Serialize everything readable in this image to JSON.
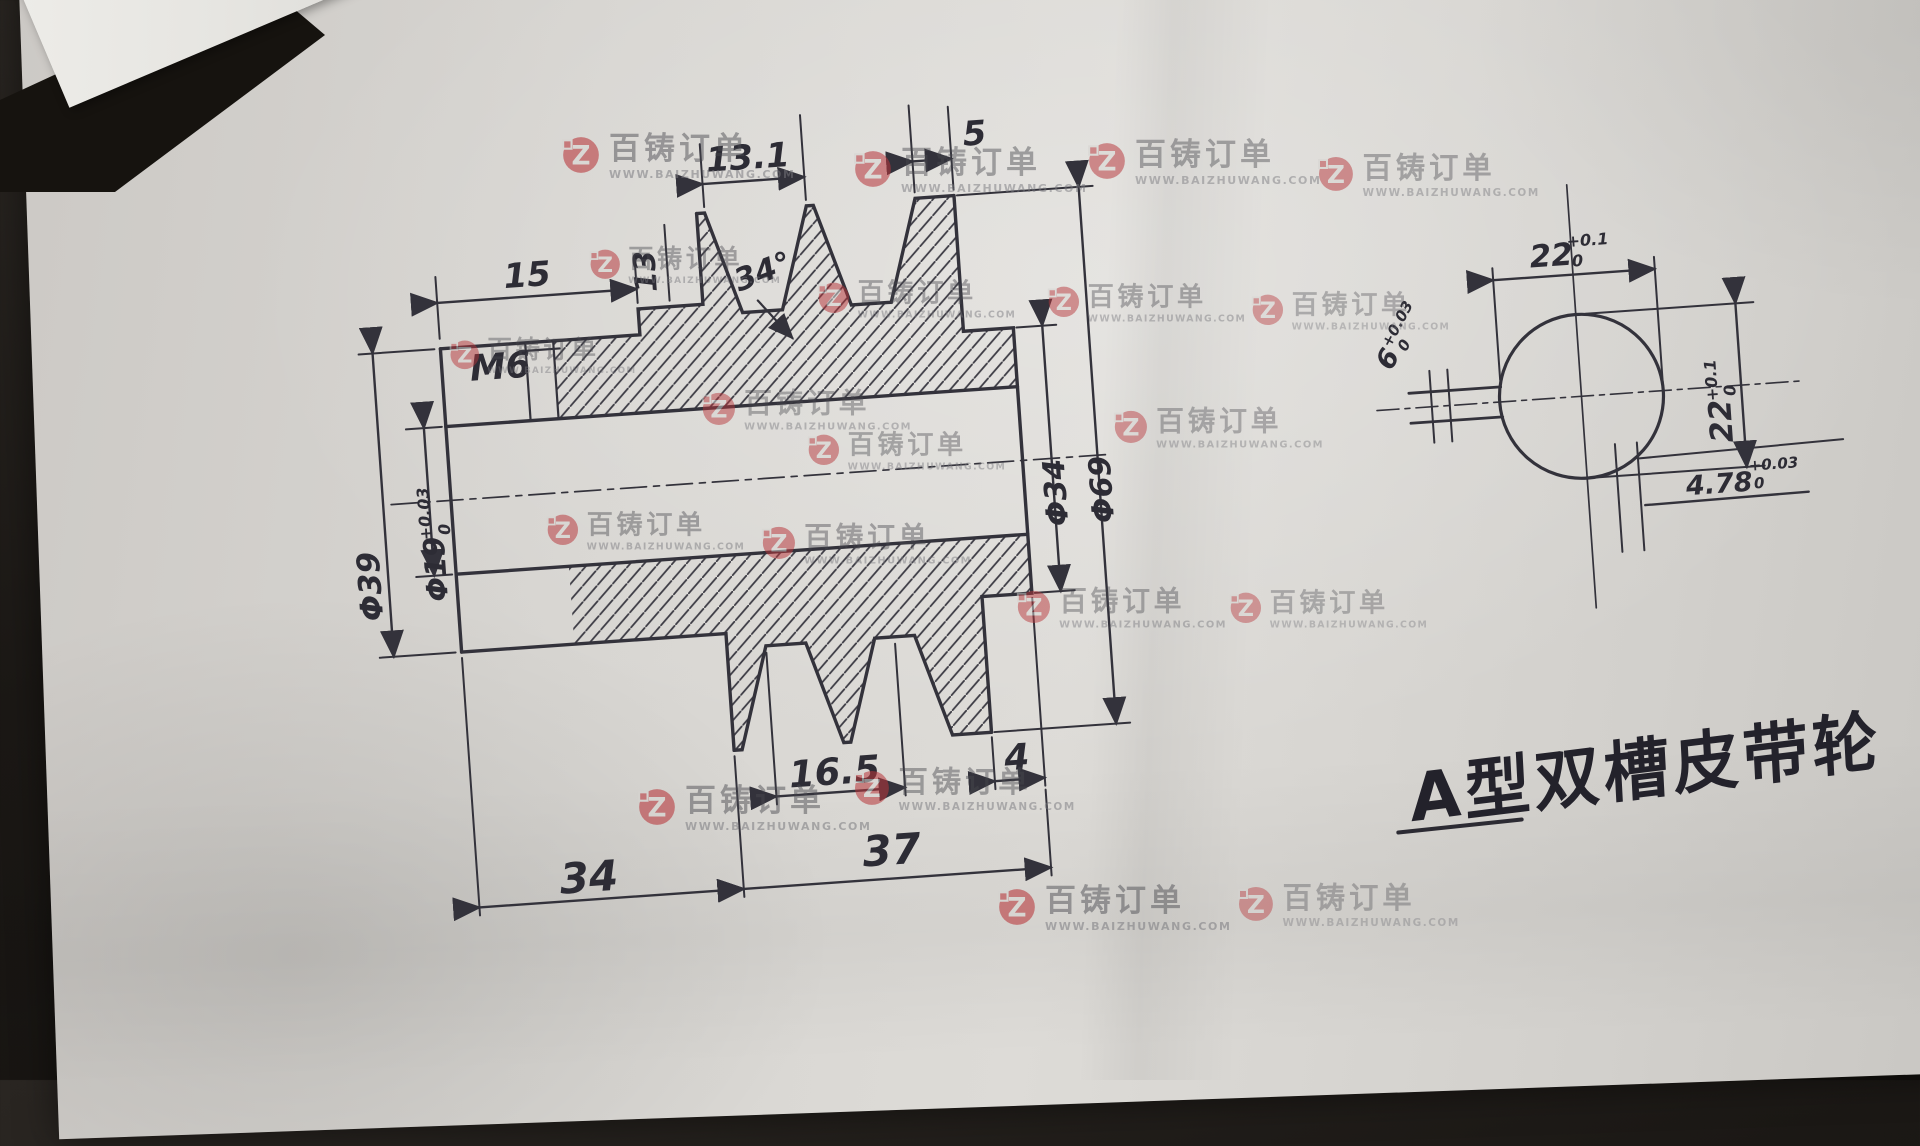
{
  "drawing": {
    "title": "A型双槽皮带轮",
    "main_view": {
      "dim_15": "15",
      "label_m6": "M6",
      "dim_13": "13",
      "dim_13_1": "13.1",
      "angle_34": "34°",
      "dim_5": "5",
      "dia_39": "Φ39",
      "dia_19": "Φ19",
      "dia_19_tol_up": "+0.03",
      "dia_19_tol_dn": "0",
      "dia_34": "Φ34",
      "dia_69": "Φ69",
      "dim_16_5": "16.5",
      "dim_4": "4",
      "dim_34": "34",
      "dim_37": "37"
    },
    "side_view": {
      "dim_22_top": "22",
      "dim_22_top_tol_up": "+0.1",
      "dim_22_top_tol_dn": "0",
      "dim_22_right": "22",
      "dim_22_right_tol_up": "+0.1",
      "dim_22_right_tol_dn": "0",
      "dim_6": "6",
      "dim_6_tol_up": "+0.03",
      "dim_6_tol_dn": "0",
      "dim_478": "4.78",
      "dim_478_tol_up": "+0.03",
      "dim_478_tol_dn": "0"
    }
  },
  "watermark": {
    "brand": "百铸订单",
    "url": "WWW.BAIZHUWANG.COM"
  }
}
